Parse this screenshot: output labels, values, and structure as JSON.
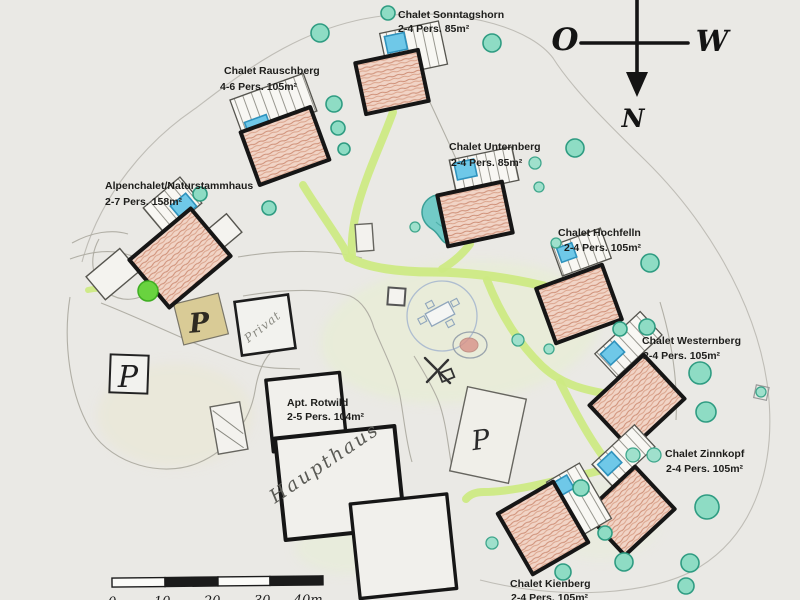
{
  "map_title": "Chalet resort site plan (hand-drawn)",
  "chalets": [
    {
      "name": "Chalet Sonntagshorn",
      "capacity": "2-4 Pers. 85m²"
    },
    {
      "name": "Chalet Rauschberg",
      "capacity": "4-6 Pers. 105m²"
    },
    {
      "name": "Chalet Unternberg",
      "capacity": "2-4 Pers. 85m²"
    },
    {
      "name": "Chalet Hochfelln",
      "capacity": "2-4 Pers. 105m²"
    },
    {
      "name": "Alpenchalet/Naturstammhaus",
      "capacity": "2-7 Pers. 158m²"
    },
    {
      "name": "Chalet Westernberg",
      "capacity": "2-4 Pers. 105m²"
    },
    {
      "name": "Chalet Zinnkopf",
      "capacity": "2-4 Pers. 105m²"
    },
    {
      "name": "Apt. Rotwild",
      "capacity": "2-5 Pers. 104m²"
    },
    {
      "name": "Chalet Kienberg",
      "capacity": "2-4 Pers. 105m²"
    }
  ],
  "buildings": {
    "main_house": "Haupthaus",
    "private": "Privat"
  },
  "parking": {
    "label": "P"
  },
  "compass": {
    "east": "O",
    "west": "W",
    "north": "N"
  },
  "scale": {
    "ticks": [
      "0",
      "10",
      "20",
      "30",
      "40m"
    ]
  },
  "colors": {
    "paper": "#eae9e5",
    "building_outline": "#161616",
    "building_fill": "#e9c0ab",
    "pool": "#6fc8e8",
    "tree": "#8edcc4",
    "path": "#cdea84",
    "pond": "#72cbc7"
  }
}
